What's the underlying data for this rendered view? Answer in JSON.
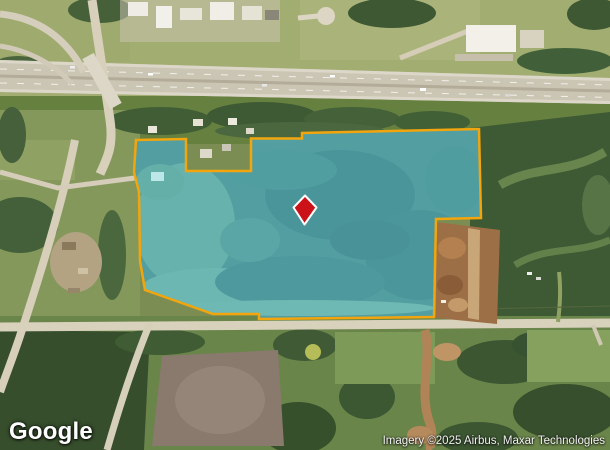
{
  "map": {
    "logo_text": "Google",
    "attribution_text": "Imagery ©2025 Airbus, Maxar Technologies",
    "parcel": {
      "points_attr": "136,140 186,139 186,171 251,171 251,138.5 302,138.5 302,133 479,129 481,218 436,219 434,317 259,319 259,314 213,314 145,290 140,261 139,192 134,172",
      "fill": "#58c8f0",
      "fill_opacity": "0.55",
      "stroke": "#f2a50c"
    },
    "marker": {
      "path": "M 305,195.5 L 316.5,207.5 L 304.5,224.5 L 293.5,207.5 Z",
      "fill": "#cb1219",
      "stroke": "#ffffff"
    }
  }
}
